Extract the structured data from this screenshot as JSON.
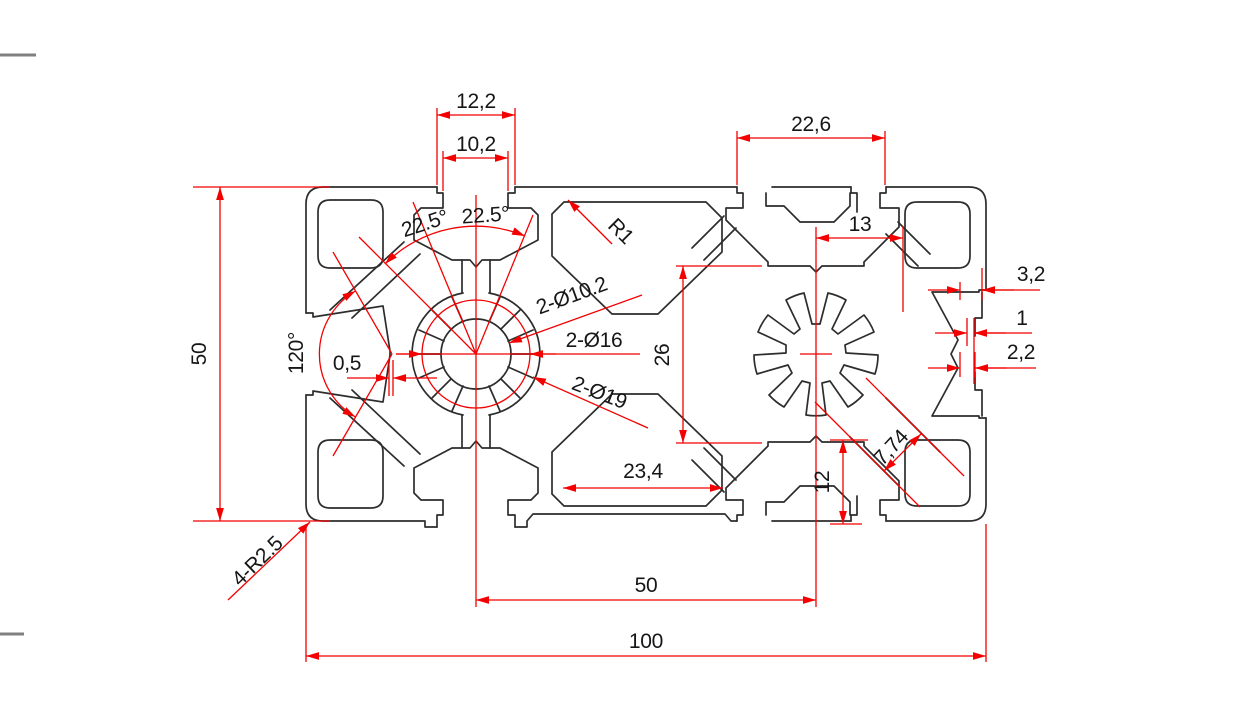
{
  "drawing": {
    "kind": "aluminum-extrusion-profile-cross-section",
    "colors": {
      "outline": "#2d2d2d",
      "dimension": "#f40000",
      "text": "#161616",
      "frame_mark": "#808080"
    },
    "dims": {
      "slot_mouth_outer": "12,2",
      "slot_mouth_inner": "10,2",
      "top_right_slot_span": "22,6",
      "center_to_wall": "13",
      "bore_chamber_height": "26",
      "bottom_cavity_width": "23,4",
      "bottom_edge_step": "12",
      "rib_channel_width": "7,74",
      "wall_thickness": "3,2",
      "lip_step_small": "1",
      "lip_step_large": "2,2",
      "vertex_flat": "0,5",
      "left_pocket_angle": "120°",
      "fan_angle_left": "22.5°",
      "fan_angle_right": "22.5°",
      "fillet_r1": "R1",
      "corner_fillets": "4-R2.5",
      "bore_small": "2-Ø10.2",
      "bore_mid": "2-Ø16",
      "bore_large": "2-Ø19",
      "profile_height": "50",
      "center_spacing": "50",
      "profile_width": "100"
    }
  }
}
